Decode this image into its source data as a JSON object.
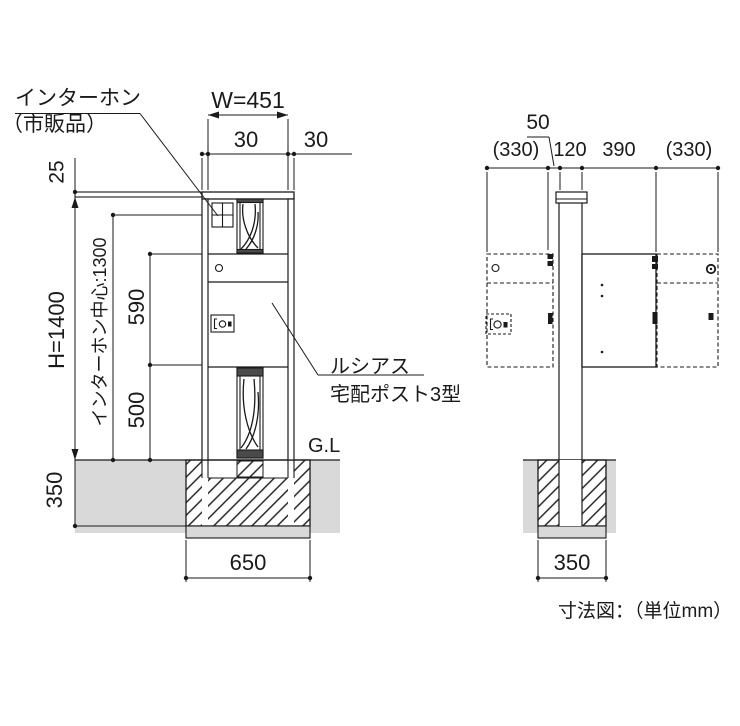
{
  "labels": {
    "intercom_line1": "インターホン",
    "intercom_line2": "（市販品）",
    "product_line1": "ルシアス",
    "product_line2": "宅配ポスト3型",
    "gl_front": "G.L",
    "caption": "寸法図：（単位mm）"
  },
  "front_dims": {
    "width": "W=451",
    "edge_left": "30",
    "edge_right": "30",
    "cap_thickness": "25",
    "height": "H=1400",
    "intercom_center": "インターホン中心:1300",
    "upper_span": "590",
    "lower_span": "500",
    "embed_depth": "350",
    "foundation_width": "650"
  },
  "side_dims": {
    "bracket_gap": "50",
    "door_swing_left": "(330)",
    "post_depth": "120",
    "box_depth": "390",
    "door_swing_right": "(330)",
    "foundation_width": "350"
  },
  "colors": {
    "line": "#1a1a1a",
    "ground": "#d9d9d9",
    "rail_fill": "#4a4a4a"
  }
}
